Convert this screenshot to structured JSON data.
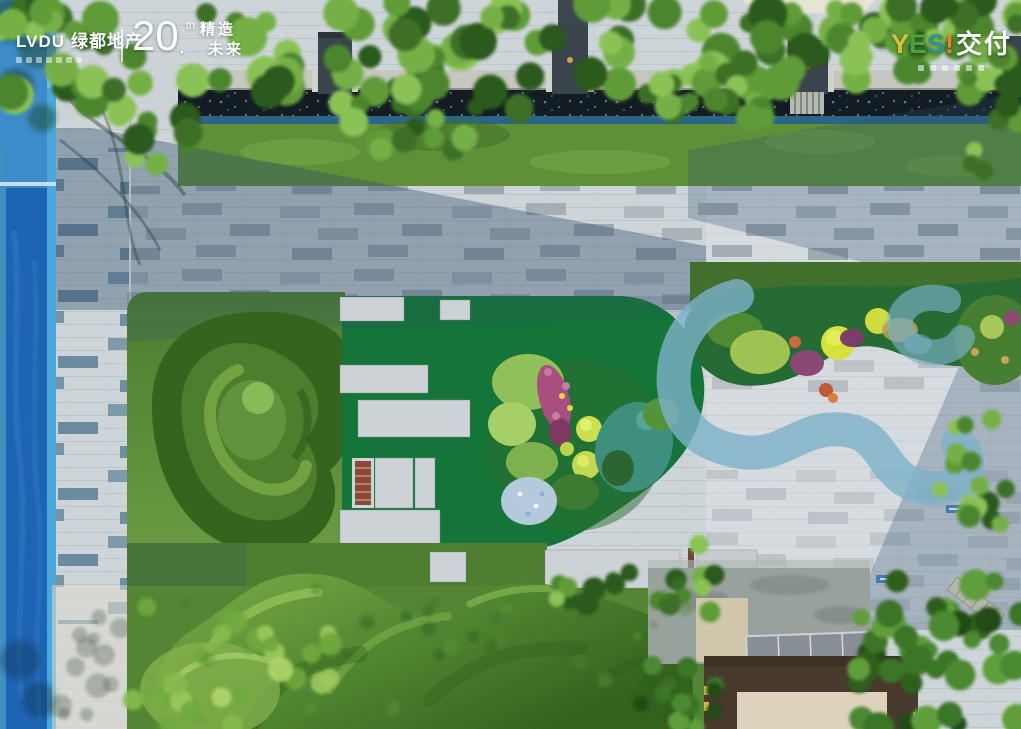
{
  "branding": {
    "lvdu": {
      "latin": "LVDU",
      "cn": "绿都地产"
    },
    "anniv": {
      "num": "20",
      "dot": ".",
      "sup": "th",
      "l1": "精造",
      "l2": "未来"
    },
    "yes": {
      "y": "Y",
      "e": "E",
      "s": "S",
      "bang": "!",
      "cn": "交付"
    }
  },
  "colors": {
    "paving": "#ced5d9",
    "pool": "#1d64b4",
    "pool_top": "#3d8cc9",
    "pool_edge": "#4aa9da",
    "turf": "#157539",
    "lawn": "#5d8c3a",
    "mound": "#35641f",
    "stream": "#7db1c9",
    "channel": "#131c22",
    "grass_top": "#5f9038",
    "hedge_light": "#85b24e",
    "roof": "#ddd3bd",
    "roof_frame": "#473a2c",
    "canopy": "#878e96",
    "sign": "#4a7ab0",
    "bench": "#8a4a38"
  }
}
